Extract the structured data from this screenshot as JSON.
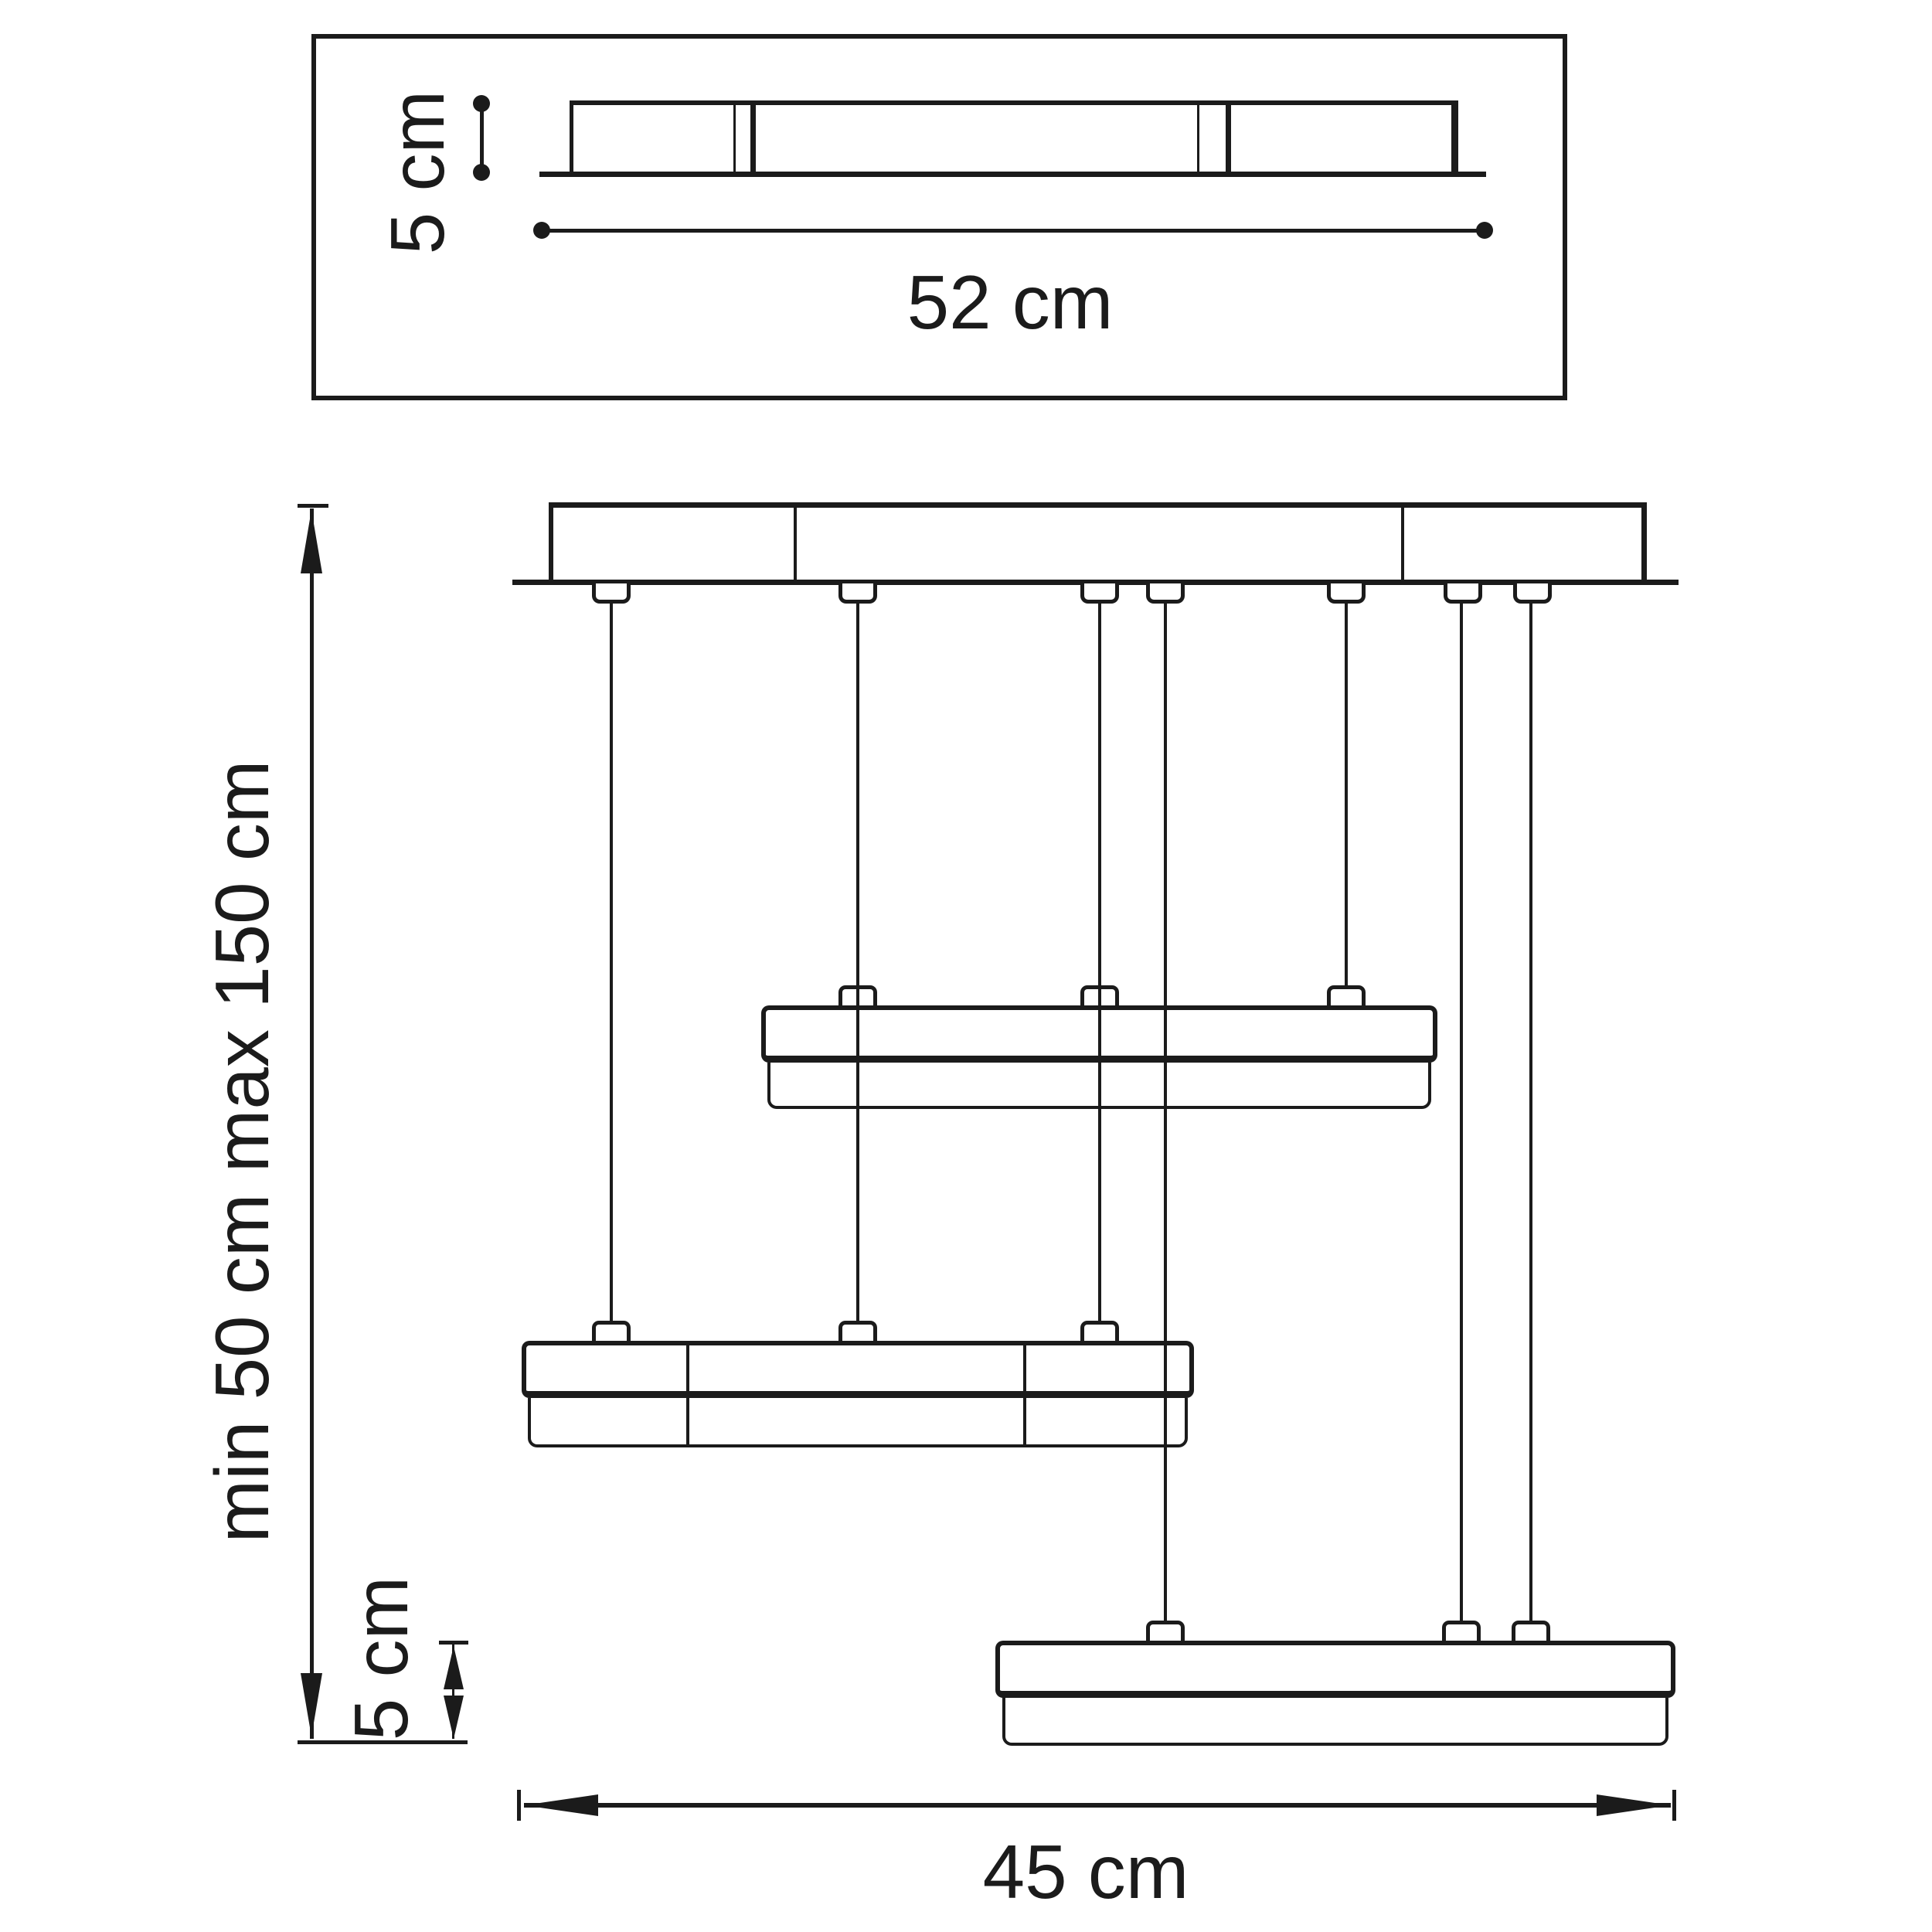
{
  "colors": {
    "ink": "#1b1b1b",
    "background": "#ffffff"
  },
  "top_view": {
    "height_label": "5 cm",
    "width_label": "52 cm"
  },
  "front_view": {
    "suspension_label": "min 50 cm max 150 cm",
    "fixture_height_label": "5 cm",
    "width_label": "45 cm"
  }
}
